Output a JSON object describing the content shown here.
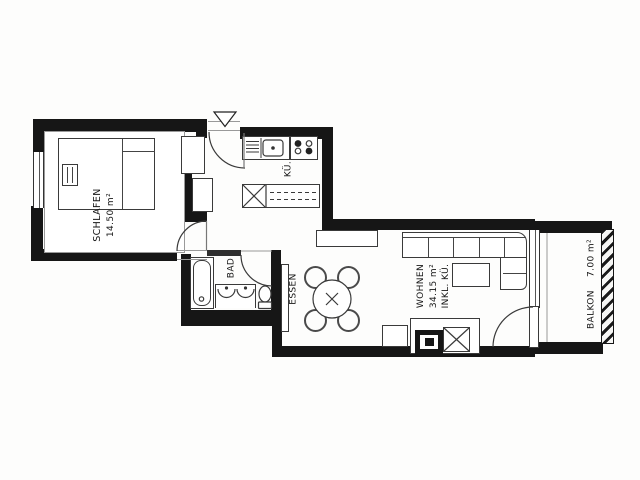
{
  "plan": {
    "rooms": {
      "schlafen": {
        "name": "SCHLAFEN",
        "area": "14.50 m²"
      },
      "bad": {
        "name": "BAD"
      },
      "essen": {
        "name": "ESSEN"
      },
      "kueche": {
        "name": "KÜ."
      },
      "wohnen": {
        "name": "WOHNEN",
        "area": "34.15 m²",
        "note": "INKL. KÜ."
      },
      "balkon": {
        "name": "BALKON",
        "area": "7.00 m²"
      }
    },
    "colors": {
      "wall": "#161616",
      "line": "#3a3a3a",
      "paper": "#ffffff"
    },
    "symbols": {
      "entrance": "entrance-arrow"
    }
  }
}
